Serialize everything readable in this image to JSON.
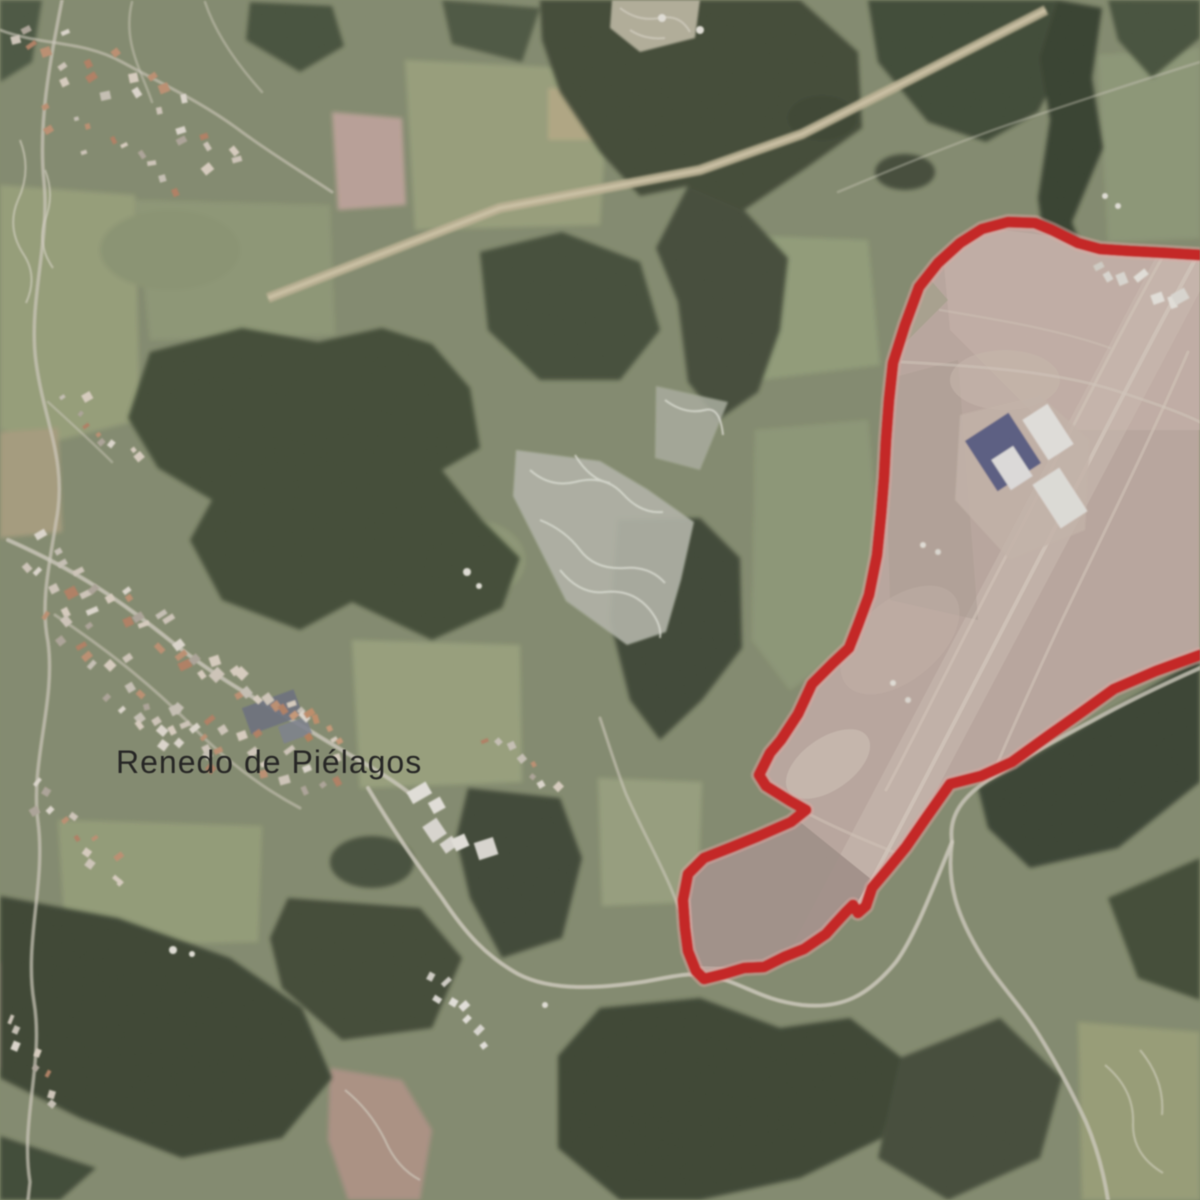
{
  "map": {
    "type": "aerial-satellite-view",
    "place_label": {
      "text": "Renedo de Piélagos",
      "color": "#161616"
    },
    "boundary": {
      "name": "highlighted-zone-outline",
      "color": "#d81512",
      "halo_color": "#f2aca6",
      "stroke_width": 11,
      "points": [
        [
          1200,
          255
        ],
        [
          1168,
          253
        ],
        [
          1130,
          251
        ],
        [
          1100,
          249
        ],
        [
          1078,
          243
        ],
        [
          1052,
          230
        ],
        [
          1035,
          223
        ],
        [
          1008,
          222
        ],
        [
          982,
          229
        ],
        [
          960,
          243
        ],
        [
          938,
          263
        ],
        [
          919,
          287
        ],
        [
          905,
          325
        ],
        [
          893,
          363
        ],
        [
          889,
          400
        ],
        [
          886,
          440
        ],
        [
          884,
          478
        ],
        [
          881,
          515
        ],
        [
          877,
          555
        ],
        [
          869,
          595
        ],
        [
          858,
          625
        ],
        [
          849,
          648
        ],
        [
          833,
          663
        ],
        [
          812,
          684
        ],
        [
          798,
          714
        ],
        [
          781,
          740
        ],
        [
          770,
          753
        ],
        [
          759,
          775
        ],
        [
          766,
          786
        ],
        [
          790,
          801
        ],
        [
          806,
          810
        ],
        [
          791,
          822
        ],
        [
          759,
          836
        ],
        [
          732,
          847
        ],
        [
          704,
          858
        ],
        [
          688,
          874
        ],
        [
          683,
          900
        ],
        [
          685,
          928
        ],
        [
          688,
          951
        ],
        [
          696,
          971
        ],
        [
          704,
          979
        ],
        [
          724,
          974
        ],
        [
          744,
          968
        ],
        [
          764,
          967
        ],
        [
          784,
          957
        ],
        [
          804,
          949
        ],
        [
          826,
          934
        ],
        [
          834,
          925
        ],
        [
          846,
          912
        ],
        [
          853,
          905
        ],
        [
          858,
          913
        ],
        [
          866,
          906
        ],
        [
          872,
          888
        ],
        [
          888,
          869
        ],
        [
          906,
          847
        ],
        [
          926,
          818
        ],
        [
          950,
          784
        ],
        [
          981,
          776
        ],
        [
          1012,
          762
        ],
        [
          1048,
          736
        ],
        [
          1082,
          712
        ],
        [
          1114,
          689
        ],
        [
          1156,
          671
        ],
        [
          1200,
          655
        ]
      ]
    },
    "palette": {
      "field_green": "#848c6c",
      "forest_dark": "#3c4731",
      "cleared_land_pink": "#c2aba1",
      "road_light": "#d8d3c4",
      "corridor_tan": "#c3b794",
      "blue_warehouse": "#565a86",
      "white_building": "#eceae6"
    }
  }
}
